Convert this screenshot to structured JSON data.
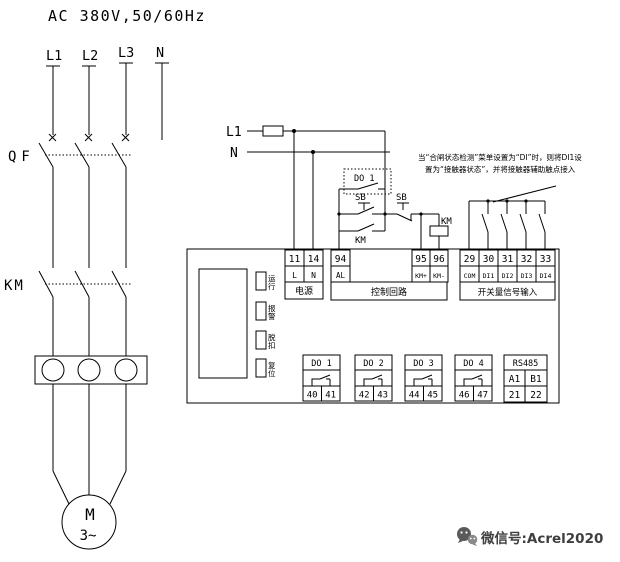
{
  "supply": {
    "title": "AC 380V,50/60Hz",
    "phase_l1": "L1",
    "phase_l2": "L2",
    "phase_l3": "L3",
    "phase_n": "N",
    "breaker_label": "QF",
    "contactor_label": "KM",
    "motor_letter": "M",
    "motor_phase": "3~"
  },
  "feed": {
    "l1": "L1",
    "n": "N"
  },
  "ctrl": {
    "do1_label": "DO 1",
    "start_button": "SB",
    "stop_button": "SB",
    "aux_contact": "KM",
    "coil": "KM"
  },
  "note": {
    "line1": "当“合闸状态检测”菜单设置为“DI”时，则将DI1设",
    "line2": "置为“接触器状态”，并将接触器辅助触点接入"
  },
  "device": {
    "power": {
      "t1": "11",
      "t2": "14",
      "s1": "L",
      "s2": "N",
      "label": "电源"
    },
    "loop": {
      "t0": "94",
      "s0": "AL",
      "t1": "95",
      "t2": "96",
      "s1": "KM+",
      "s2": "KM-",
      "label": "控制回路"
    },
    "di": {
      "t": [
        "29",
        "30",
        "31",
        "32",
        "33"
      ],
      "s": [
        "COM",
        "DI1",
        "DI2",
        "DI3",
        "DI4"
      ],
      "label": "开关量信号输入"
    },
    "leds": [
      {
        "c1": "运",
        "c2": "行"
      },
      {
        "c1": "报",
        "c2": "警"
      },
      {
        "c1": "脱",
        "c2": "扣"
      },
      {
        "c1": "复",
        "c2": "位"
      }
    ],
    "outputs": [
      {
        "label": "DO 1",
        "a": "40",
        "b": "41"
      },
      {
        "label": "DO 2",
        "a": "42",
        "b": "43"
      },
      {
        "label": "DO 3",
        "a": "44",
        "b": "45"
      },
      {
        "label": "DO 4",
        "a": "46",
        "b": "47"
      }
    ],
    "comm": {
      "label": "RS485",
      "a": "A1",
      "b": "B1",
      "c": "21",
      "d": "22"
    }
  },
  "watermark": {
    "text": "微信号:Acrel2020"
  }
}
